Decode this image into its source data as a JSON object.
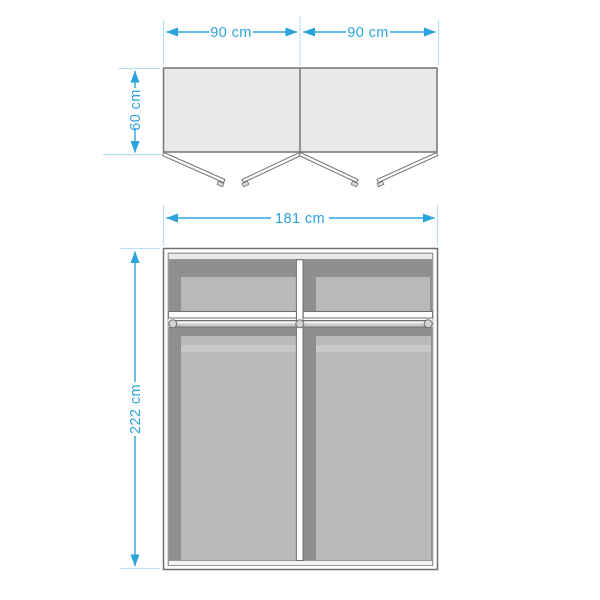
{
  "top_view": {
    "dim_width_left": "90 cm",
    "dim_width_right": "90 cm",
    "dim_depth": "60 cm"
  },
  "front_view": {
    "dim_width_total": "181 cm",
    "dim_height": "222 cm"
  },
  "colors": {
    "dimension_accent": "#2aa3db",
    "extension_line": "#b8e0f2",
    "outline_gray": "#757575",
    "cabinet_fill_light": "#e9e9e9",
    "interior_dark": "#8f8f8f",
    "interior_light": "#b9b9b9",
    "background": "#ffffff"
  }
}
